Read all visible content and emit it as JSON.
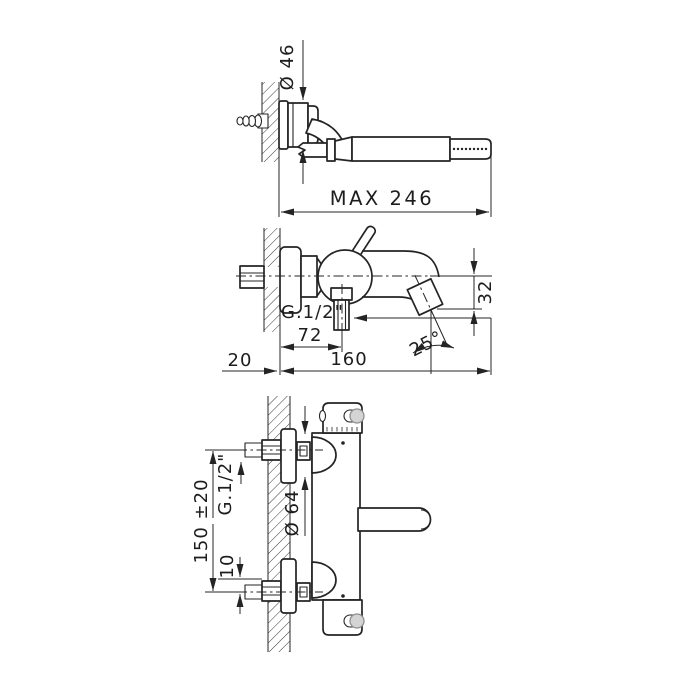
{
  "drawing": {
    "background": "#ffffff",
    "line_color": "#242424",
    "views": {
      "hand_shower": {
        "name": "wall bracket with hand shower - top view",
        "labels": {
          "diameter": "Ø 46",
          "max_projection": "MAX 246"
        }
      },
      "bath_mixer": {
        "name": "wall mounted bath mixer with spout - side view",
        "labels": {
          "outlet_thread": "G.1/2\"",
          "outlet_offset": "72",
          "projection": "160",
          "wall_offset": "20",
          "spout_drop": "32",
          "spout_angle": "25°"
        }
      },
      "thermostatic_mixer": {
        "name": "thermostatic shower mixer - side view",
        "labels": {
          "inlet_spacing": "150 ±20",
          "inlet_thread": "G.1/2\"",
          "escutcheon_diameter": "Ø 64",
          "offset": "10"
        }
      }
    }
  }
}
